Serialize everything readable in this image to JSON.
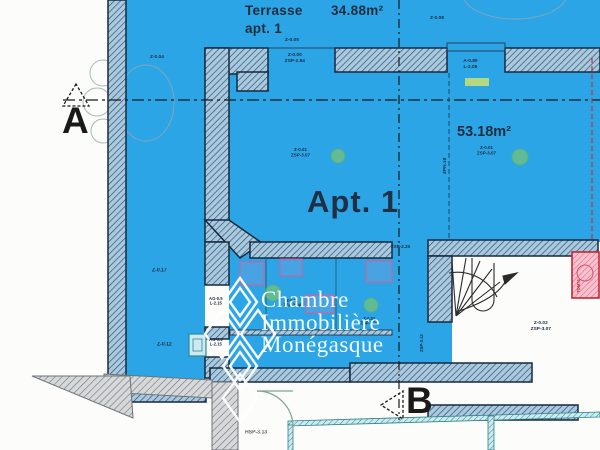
{
  "title": "Floor plan - Apt. 1",
  "colors": {
    "plan_blue": "#2ca5e6",
    "wall_dark": "#14293f",
    "wall_hatch_bg": "#a9c9df",
    "gray_wall": "#6e7478",
    "teal": "#2e7f8d",
    "pink_shaft_border": "#c22838",
    "green_dot": "#8ecf55",
    "highlight_green": "#ccdf70",
    "section_line": "#1a1a1a",
    "red_dashed_line": "#c03040"
  },
  "watermark": {
    "text": "Chambre\nImmobilière\nMonégasque",
    "logo": "diamond-lattice"
  },
  "markers": {
    "a": "A",
    "b": "B"
  },
  "areas": {
    "terrace_name": "Terrasse\napt. 1",
    "terrace_area": "34.88m²",
    "apartment_name": "Apt. 1",
    "apartment_area": "53.18m²"
  },
  "labels": {
    "edge_top": "Z-0.04",
    "lvl_top_left": "Z-0.04",
    "lvl_top_mid": "Z-0.05",
    "lvl_top_right": "Z-0.08",
    "open_terrace": "Z-0.00\nZSP-2.84",
    "open_window": "A-0.80\nL-2.05",
    "room_pt_left": "Z-0.01\nZSP-3.07",
    "room_pt_right": "Z-0.01\nZSP-3.07",
    "door_height": "ZSP-2.25",
    "lvl_left_upper": "Z-0.17",
    "lvl_left_lower": "Z-0.12",
    "win_left_1": "AG-0.5\nL-2.15",
    "win_left_2": "AG-0.5\nL-2.15",
    "bath_pt_1": "Z-0.01\nZSP-3.08",
    "bath_pt_2": "Z-0.01\nZSP-3.08",
    "stair_pt": "Z-0.02\nZSP-3.07",
    "joint_line": "ZPN.19",
    "corridor_height": "ZSP-3.13",
    "shaft": "TDM74",
    "below_height": "HSP-3.13"
  }
}
